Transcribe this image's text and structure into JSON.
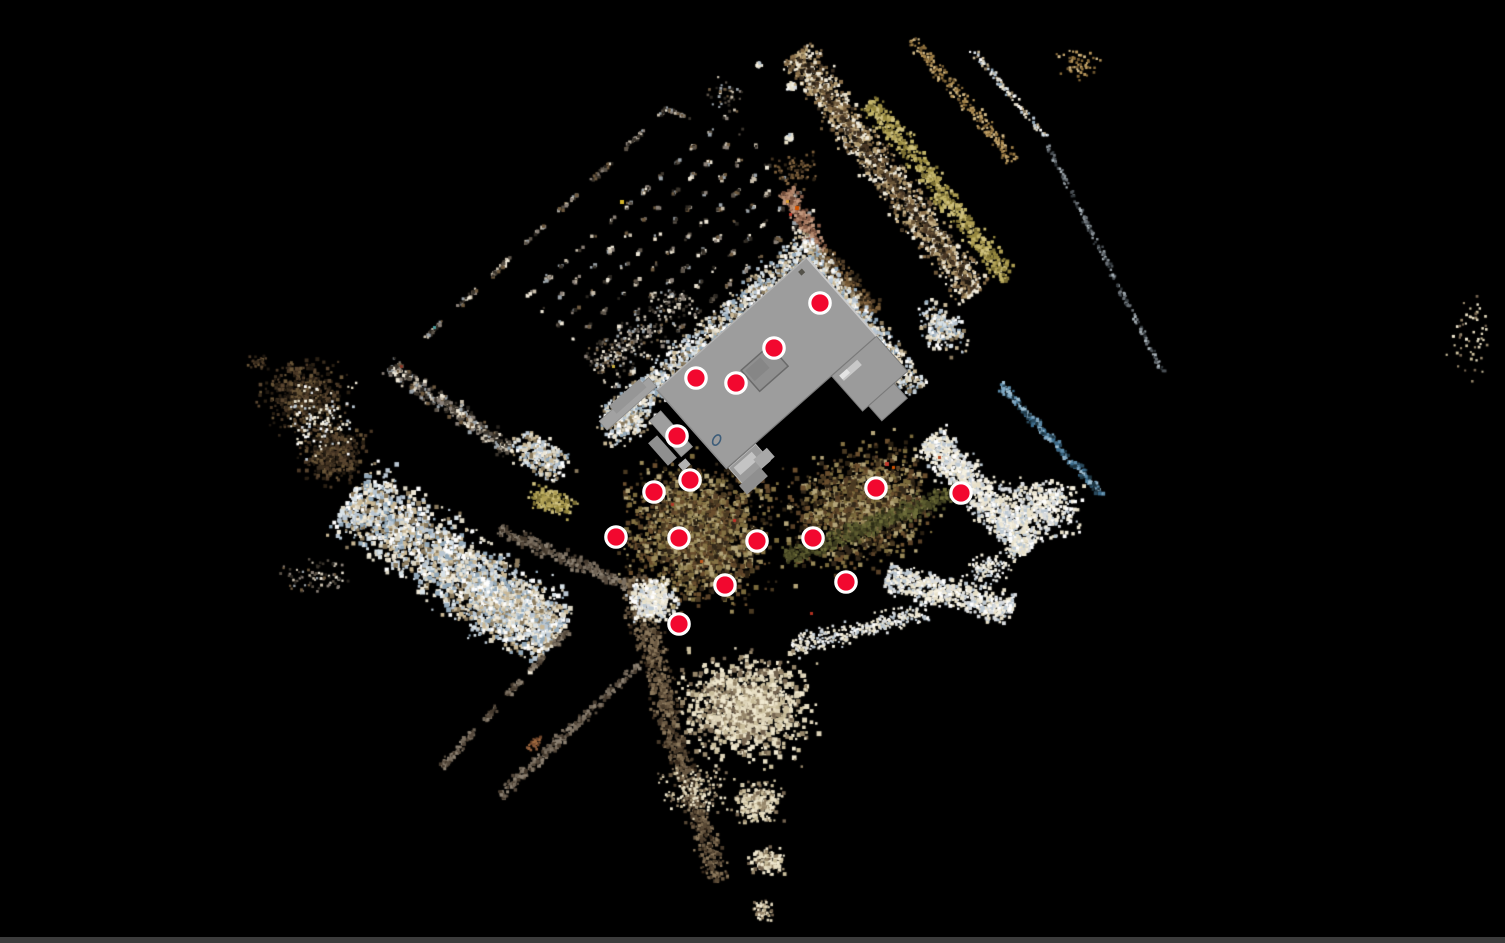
{
  "app": {
    "name": "point-cloud-viewer",
    "background": "#000000",
    "viewport": {
      "w": 1505,
      "h": 943
    },
    "bottom_bar_color": "#3c3c3c"
  },
  "markers": {
    "color": "#f2082f",
    "ring_color": "#ffffff",
    "radius": 10.2,
    "ring_width": 3.2,
    "positions": [
      [
        820,
        303
      ],
      [
        774,
        348
      ],
      [
        696,
        378
      ],
      [
        736,
        383
      ],
      [
        677,
        436
      ],
      [
        690,
        480
      ],
      [
        654,
        492
      ],
      [
        876,
        488
      ],
      [
        961,
        493
      ],
      [
        616,
        537
      ],
      [
        679,
        538
      ],
      [
        757,
        541
      ],
      [
        813,
        538
      ],
      [
        725,
        585
      ],
      [
        846,
        582
      ],
      [
        679,
        624
      ]
    ]
  },
  "building": {
    "origin": [
      657,
      390
    ],
    "rotation_deg": -41.5,
    "rects": [
      {
        "x": -64,
        "y": -15,
        "w": 66,
        "h": 12,
        "f": "#a2a2a2",
        "s": "#8a8a8a",
        "sw": 0.8,
        "name": "walkway-nw"
      },
      {
        "x": -46,
        "y": -20,
        "w": 40,
        "h": 11,
        "f": "#969696",
        "name": "walkway-nw-2"
      },
      {
        "x": -26,
        "y": 18,
        "w": 15,
        "h": 48,
        "f": "#9e9e9e",
        "s": "#8a8a8a",
        "sw": 0.8,
        "name": "walkway-sw"
      },
      {
        "x": -42,
        "y": 34,
        "w": 12,
        "h": 30,
        "f": "#8f8f8f",
        "name": "walkway-sw-2"
      },
      {
        "x": -34,
        "y": 70,
        "w": 10,
        "h": 8,
        "f": "#b2b2b2",
        "name": "walkway-bit"
      },
      {
        "x": 2,
        "y": 106,
        "w": 36,
        "h": 22,
        "f": "#9a9a9a",
        "s": "#c2c2c2",
        "sw": 0.8,
        "name": "south-deck"
      },
      {
        "x": 6,
        "y": 109,
        "w": 24,
        "h": 10,
        "f": "#c4c4c4",
        "name": "south-deck-step"
      },
      {
        "x": -2,
        "y": 126,
        "w": 28,
        "h": 12,
        "f": "#8f8f8f",
        "name": "south-deck-lower"
      },
      {
        "x": 26,
        "y": 116,
        "w": 18,
        "h": 12,
        "f": "#a8a8a8",
        "name": "south-deck-side"
      },
      {
        "x": 140,
        "y": 105,
        "w": 60,
        "h": 47,
        "f": "#9b9b9b",
        "s": "#7a7a7a",
        "sw": 1,
        "name": "east-wing"
      },
      {
        "x": 148,
        "y": 152,
        "w": 34,
        "h": 20,
        "f": "#999999",
        "s": "#7a7a7a",
        "sw": 1,
        "name": "east-wing-extension"
      },
      {
        "x": 0,
        "y": 0,
        "w": 200,
        "h": 105,
        "f": "#9d9d9d",
        "s": "#7a7a7a",
        "sw": 1.2,
        "name": "main-roof"
      },
      {
        "x": 146,
        "y": 110,
        "w": 24,
        "h": 7,
        "f": "#c8c8c8",
        "name": "wing-light-bar"
      },
      {
        "x": 146,
        "y": 110,
        "w": 10,
        "h": 5,
        "f": "#e4e4e4",
        "name": "wing-white-bit"
      },
      {
        "x": 76,
        "y": 41,
        "w": 38,
        "h": 28,
        "f": "#909090",
        "s": "#6a6a6a",
        "sw": 1.5,
        "name": "skylight"
      },
      {
        "x": 79,
        "y": 44,
        "w": 20,
        "h": 14,
        "f": "#868686",
        "name": "skylight-inner"
      },
      {
        "x": 184,
        "y": 5,
        "w": 5,
        "h": 5,
        "f": "#54524a",
        "name": "roof-vent"
      }
    ],
    "edge_lines": [
      {
        "x1": 200,
        "y1": 0,
        "x2": 200,
        "y2": 105,
        "s": "#c9c9c9",
        "sw": 2
      },
      {
        "x1": 0,
        "y1": 0,
        "x2": 200,
        "y2": 0,
        "s": "#b3b3b3",
        "sw": 1.5
      },
      {
        "x1": 0,
        "y1": 0,
        "x2": 0,
        "y2": 105,
        "s": "#8c8c8c",
        "sw": 1.5
      }
    ],
    "ellipse": {
      "cx": 11.5,
      "cy": 77,
      "rx": 5.5,
      "ry": 3.5,
      "rot": -20,
      "stroke": "#3d5d7a",
      "sw": 1.6,
      "name": "floor-object-outline"
    }
  },
  "cloud": {
    "seed": 1337,
    "palettes": {
      "bright": [
        "#f0e9d8",
        "#ffffff",
        "#dcd6c4",
        "#b9c6d2",
        "#93a9ba",
        "#c9b896",
        "#8a7a5e",
        "#d8e2e8"
      ],
      "snow": [
        "#f7f2e2",
        "#ffffff",
        "#ece6d4",
        "#d8dbde",
        "#bcc8d2",
        "#e8e0c8"
      ],
      "cream": [
        "#ddd3b8",
        "#cabe9c",
        "#f0e8d0",
        "#96866a",
        "#746450",
        "#e8dfc4"
      ],
      "tan": [
        "#c2a36a",
        "#b5945a",
        "#a08048",
        "#8a6c3a",
        "#d4bc8a",
        "#6e5630"
      ],
      "khaki": [
        "#b0a055",
        "#c2b468",
        "#96883f",
        "#7a6e33",
        "#d0c280"
      ],
      "brown": [
        "#6b5232",
        "#54402a",
        "#7d5f3a",
        "#42321f",
        "#8a6a45",
        "#2e2416"
      ],
      "darkbrown": [
        "#3a2d1e",
        "#2a2014",
        "#4a3826",
        "#1f1810",
        "#5a4630",
        "#6a5638"
      ],
      "olive": [
        "#4a4a26",
        "#5c5c30",
        "#3a3a1e",
        "#6e6e3a",
        "#2c2c16",
        "#56562c"
      ],
      "garden": [
        "#6b4f2e",
        "#4a3a22",
        "#7a6a3c",
        "#9a8a5a",
        "#33281a",
        "#b5a67a",
        "#5a4228",
        "#857244",
        "#2a2012"
      ],
      "blue": [
        "#5b8aa8",
        "#7fa8c4",
        "#3a6a8a",
        "#2a4a5e",
        "#9fc0d4",
        "#1e3642"
      ],
      "slate": [
        "#6a7076",
        "#4a5055",
        "#8a9298",
        "#aab4ba",
        "#30363a"
      ],
      "graybrown": [
        "#6e6355",
        "#7d7162",
        "#55493c",
        "#8d8273",
        "#453a2e"
      ],
      "roadbrown": [
        "#6b5a44",
        "#7d6a50",
        "#4a3c2c",
        "#8d7a5e",
        "#5a4a36",
        "#36291c"
      ],
      "roadmix": [
        "#c9b38a",
        "#e8e0cc",
        "#8a6f4a",
        "#3a2f22",
        "#b09a6e",
        "#f2ecdc",
        "#6e583a"
      ],
      "path": [
        "#a87a62",
        "#b58a6e",
        "#8a5f4a",
        "#c49a80",
        "#6e4a38"
      ],
      "mixed": [
        "#8a8078",
        "#5a5248",
        "#c8beac",
        "#3a342c",
        "#9aa2a8",
        "#6e5a40",
        "#efe8d8",
        "#2a2620"
      ],
      "rust": [
        "#8a5a3a",
        "#a06a40",
        "#6e452a"
      ]
    },
    "clusters": [
      {
        "t": "dash",
        "x": 545,
        "y": 222,
        "l": 335,
        "w": 6,
        "a": -43.5,
        "n": 300,
        "p": "mixed",
        "s": [
          2,
          4
        ],
        "d": [
          26,
          20
        ]
      },
      {
        "t": "band",
        "x": 676,
        "y": 112,
        "l": 28,
        "w": 5,
        "a": 20,
        "n": 40,
        "p": "mixed",
        "s": [
          2,
          3
        ]
      },
      {
        "t": "rows",
        "x": 672,
        "y": 248,
        "l": 280,
        "w": 150,
        "a": -42,
        "n": 1400,
        "p": "mixed",
        "s": [
          2,
          4
        ],
        "g": 21,
        "d": [
          9,
          13
        ]
      },
      {
        "t": "blob",
        "x": 788,
        "y": 85,
        "l": 14,
        "w": 12,
        "a": 0,
        "n": 30,
        "p": "snow",
        "s": [
          2,
          4
        ]
      },
      {
        "t": "blob",
        "x": 787,
        "y": 137,
        "l": 12,
        "w": 10,
        "a": 0,
        "n": 24,
        "p": "snow",
        "s": [
          2,
          4
        ]
      },
      {
        "t": "blob",
        "x": 757,
        "y": 63,
        "l": 10,
        "w": 8,
        "a": 0,
        "n": 14,
        "p": "snow",
        "s": [
          2,
          3
        ]
      },
      {
        "t": "blob",
        "x": 725,
        "y": 95,
        "l": 56,
        "w": 44,
        "a": 0,
        "n": 40,
        "p": "mixed",
        "s": [
          2,
          3
        ]
      },
      {
        "t": "band",
        "x": 802,
        "y": 220,
        "l": 70,
        "w": 24,
        "a": 62,
        "n": 260,
        "p": "path",
        "s": [
          2,
          4
        ]
      },
      {
        "t": "band",
        "x": 846,
        "y": 282,
        "l": 80,
        "w": 30,
        "a": 50,
        "n": 280,
        "p": "brown",
        "s": [
          2,
          4
        ]
      },
      {
        "t": "band",
        "x": 884,
        "y": 172,
        "l": 300,
        "w": 52,
        "a": 53,
        "n": 1500,
        "p": "roadmix",
        "s": [
          2,
          4
        ]
      },
      {
        "t": "band",
        "x": 884,
        "y": 172,
        "l": 290,
        "w": 12,
        "a": 53,
        "n": 220,
        "p": "darkbrown",
        "s": [
          2,
          4
        ]
      },
      {
        "t": "band",
        "x": 938,
        "y": 188,
        "l": 225,
        "w": 32,
        "a": 52,
        "n": 650,
        "p": "khaki",
        "s": [
          2,
          4
        ]
      },
      {
        "t": "band",
        "x": 962,
        "y": 98,
        "l": 160,
        "w": 22,
        "a": 50,
        "n": 240,
        "p": "tan",
        "s": [
          2,
          3
        ]
      },
      {
        "t": "band",
        "x": 1008,
        "y": 92,
        "l": 115,
        "w": 10,
        "a": 50,
        "n": 110,
        "p": "bright",
        "s": [
          2,
          3
        ]
      },
      {
        "t": "blob",
        "x": 1078,
        "y": 63,
        "l": 64,
        "w": 44,
        "a": 0,
        "n": 55,
        "p": "tan",
        "s": [
          2,
          3
        ]
      },
      {
        "t": "band",
        "x": 1104,
        "y": 258,
        "l": 255,
        "w": 8,
        "a": 63,
        "n": 200,
        "p": "slate",
        "s": [
          2,
          3
        ]
      },
      {
        "t": "blob",
        "x": 1468,
        "y": 330,
        "l": 70,
        "w": 110,
        "a": 0,
        "n": 55,
        "p": "cream",
        "s": [
          2,
          3
        ]
      },
      {
        "t": "band",
        "x": 712,
        "y": 330,
        "l": 270,
        "w": 48,
        "a": -41.5,
        "n": 1150,
        "p": "bright",
        "s": [
          2,
          4
        ]
      },
      {
        "t": "band",
        "x": 862,
        "y": 322,
        "l": 170,
        "w": 42,
        "a": 52,
        "n": 700,
        "p": "bright",
        "s": [
          2,
          4
        ]
      },
      {
        "t": "blob",
        "x": 624,
        "y": 418,
        "l": 76,
        "w": 56,
        "a": -40,
        "n": 300,
        "p": "bright",
        "s": [
          2,
          4
        ]
      },
      {
        "t": "blob",
        "x": 940,
        "y": 326,
        "l": 76,
        "w": 52,
        "a": 50,
        "n": 230,
        "p": "bright",
        "s": [
          2,
          4
        ]
      },
      {
        "t": "blob",
        "x": 695,
        "y": 532,
        "l": 184,
        "w": 184,
        "a": 0,
        "n": 2100,
        "p": "garden",
        "s": [
          2,
          5
        ]
      },
      {
        "t": "blob",
        "x": 858,
        "y": 505,
        "l": 190,
        "w": 150,
        "a": -18,
        "n": 1500,
        "p": "garden",
        "s": [
          2,
          5
        ]
      },
      {
        "t": "band",
        "x": 872,
        "y": 523,
        "l": 190,
        "w": 28,
        "a": -21,
        "n": 600,
        "p": "olive",
        "s": [
          2,
          4
        ]
      },
      {
        "t": "band",
        "x": 978,
        "y": 492,
        "l": 150,
        "w": 52,
        "a": 47,
        "n": 1100,
        "p": "snow",
        "s": [
          2,
          4
        ]
      },
      {
        "t": "band",
        "x": 948,
        "y": 592,
        "l": 130,
        "w": 42,
        "a": 15,
        "n": 650,
        "p": "snow",
        "s": [
          2,
          4
        ]
      },
      {
        "t": "band",
        "x": 858,
        "y": 628,
        "l": 140,
        "w": 30,
        "a": -15,
        "n": 350,
        "p": "snow",
        "s": [
          2,
          3
        ]
      },
      {
        "t": "band",
        "x": 1050,
        "y": 438,
        "l": 150,
        "w": 13,
        "a": 47,
        "n": 240,
        "p": "blue",
        "s": [
          2,
          4
        ]
      },
      {
        "t": "blob",
        "x": 1038,
        "y": 506,
        "l": 104,
        "w": 76,
        "a": 0,
        "n": 450,
        "p": "snow",
        "s": [
          2,
          4
        ]
      },
      {
        "t": "blob",
        "x": 988,
        "y": 568,
        "l": 60,
        "w": 44,
        "a": 0,
        "n": 120,
        "p": "snow",
        "s": [
          2,
          3
        ]
      },
      {
        "t": "blob",
        "x": 303,
        "y": 396,
        "l": 104,
        "w": 88,
        "a": 0,
        "n": 550,
        "p": "darkbrown",
        "s": [
          2,
          4
        ]
      },
      {
        "t": "blob",
        "x": 330,
        "y": 452,
        "l": 84,
        "w": 76,
        "a": 0,
        "n": 420,
        "p": "darkbrown",
        "s": [
          2,
          4
        ]
      },
      {
        "t": "blob",
        "x": 318,
        "y": 420,
        "l": 96,
        "w": 96,
        "a": 0,
        "n": 110,
        "p": "snow",
        "s": [
          2,
          3
        ]
      },
      {
        "t": "blob",
        "x": 256,
        "y": 362,
        "l": 28,
        "w": 20,
        "a": 0,
        "n": 35,
        "p": "darkbrown",
        "s": [
          2,
          3
        ]
      },
      {
        "t": "band",
        "x": 448,
        "y": 406,
        "l": 150,
        "w": 28,
        "a": 35,
        "n": 360,
        "p": "mixed",
        "s": [
          2,
          4
        ]
      },
      {
        "t": "blob",
        "x": 540,
        "y": 455,
        "l": 84,
        "w": 52,
        "a": 30,
        "n": 320,
        "p": "bright",
        "s": [
          2,
          4
        ]
      },
      {
        "t": "blob",
        "x": 550,
        "y": 500,
        "l": 68,
        "w": 32,
        "a": 20,
        "n": 170,
        "p": "khaki",
        "s": [
          2,
          4
        ]
      },
      {
        "t": "band",
        "x": 452,
        "y": 565,
        "l": 250,
        "w": 105,
        "a": 35,
        "n": 2400,
        "p": "bright",
        "s": [
          2,
          5
        ]
      },
      {
        "t": "band",
        "x": 562,
        "y": 556,
        "l": 140,
        "w": 20,
        "a": 24,
        "n": 300,
        "p": "graybrown",
        "s": [
          2,
          4
        ]
      },
      {
        "t": "blob",
        "x": 312,
        "y": 576,
        "l": 90,
        "w": 44,
        "a": 0,
        "n": 80,
        "p": "mixed",
        "s": [
          2,
          3
        ]
      },
      {
        "t": "blob",
        "x": 505,
        "y": 607,
        "l": 130,
        "w": 84,
        "a": 0,
        "n": 650,
        "p": "bright",
        "s": [
          2,
          4
        ]
      },
      {
        "t": "dash",
        "x": 503,
        "y": 697,
        "l": 185,
        "w": 9,
        "a": 133,
        "n": 260,
        "p": "graybrown",
        "s": [
          2,
          4
        ],
        "d": [
          20,
          14
        ]
      },
      {
        "t": "band",
        "x": 451,
        "y": 756,
        "l": 30,
        "w": 10,
        "a": 133,
        "n": 55,
        "p": "graybrown",
        "s": [
          2,
          3
        ]
      },
      {
        "t": "band",
        "x": 568,
        "y": 729,
        "l": 190,
        "w": 15,
        "a": 137,
        "n": 280,
        "p": "graybrown",
        "s": [
          2,
          4
        ]
      },
      {
        "t": "blob",
        "x": 533,
        "y": 742,
        "l": 28,
        "w": 14,
        "a": -43,
        "n": 28,
        "p": "rust",
        "s": [
          2,
          3
        ]
      },
      {
        "t": "band",
        "x": 650,
        "y": 648,
        "l": 150,
        "w": 40,
        "a": 75,
        "n": 520,
        "p": "roadbrown",
        "s": [
          2,
          4
        ]
      },
      {
        "t": "band",
        "x": 692,
        "y": 798,
        "l": 170,
        "w": 34,
        "a": 72,
        "n": 480,
        "p": "roadbrown",
        "s": [
          2,
          4
        ]
      },
      {
        "t": "blob",
        "x": 745,
        "y": 706,
        "l": 164,
        "w": 132,
        "a": 0,
        "n": 1350,
        "p": "cream",
        "s": [
          2,
          5
        ]
      },
      {
        "t": "blob",
        "x": 652,
        "y": 598,
        "l": 60,
        "w": 56,
        "a": 0,
        "n": 330,
        "p": "snow",
        "s": [
          2,
          4
        ]
      },
      {
        "t": "blob",
        "x": 756,
        "y": 802,
        "l": 68,
        "w": 52,
        "a": 0,
        "n": 240,
        "p": "cream",
        "s": [
          2,
          4
        ]
      },
      {
        "t": "blob",
        "x": 766,
        "y": 860,
        "l": 48,
        "w": 36,
        "a": 0,
        "n": 140,
        "p": "cream",
        "s": [
          2,
          4
        ]
      },
      {
        "t": "blob",
        "x": 762,
        "y": 908,
        "l": 30,
        "w": 28,
        "a": 0,
        "n": 70,
        "p": "cream",
        "s": [
          2,
          3
        ]
      },
      {
        "t": "blob",
        "x": 695,
        "y": 788,
        "l": 90,
        "w": 70,
        "a": 0,
        "n": 160,
        "p": "cream",
        "s": [
          2,
          3
        ]
      },
      {
        "t": "blob",
        "x": 792,
        "y": 168,
        "l": 60,
        "w": 44,
        "a": 0,
        "n": 70,
        "p": "brown",
        "s": [
          2,
          3
        ]
      },
      {
        "t": "band",
        "x": 640,
        "y": 332,
        "l": 120,
        "w": 55,
        "a": -40,
        "n": 260,
        "p": "mixed",
        "s": [
          2,
          3
        ]
      }
    ],
    "accents": [
      [
        433,
        326,
        "#4a9a9a",
        3
      ],
      [
        400,
        365,
        "#8a3a2a",
        3
      ],
      [
        620,
        200,
        "#d4b52a",
        4
      ],
      [
        612,
        365,
        "#c9b040",
        3
      ],
      [
        885,
        462,
        "#c0392b",
        4
      ],
      [
        892,
        466,
        "#d35400",
        3
      ],
      [
        938,
        456,
        "#b04a28",
        3
      ],
      [
        795,
        206,
        "#d35400",
        4
      ],
      [
        789,
        213,
        "#c0392b",
        3
      ],
      [
        786,
        200,
        "#e0a030",
        3
      ],
      [
        733,
        519,
        "#c03028",
        3
      ],
      [
        810,
        612,
        "#b03020",
        3
      ],
      [
        700,
        560,
        "#c05a20",
        3
      ],
      [
        671,
        503,
        "#b03828",
        3
      ]
    ]
  }
}
